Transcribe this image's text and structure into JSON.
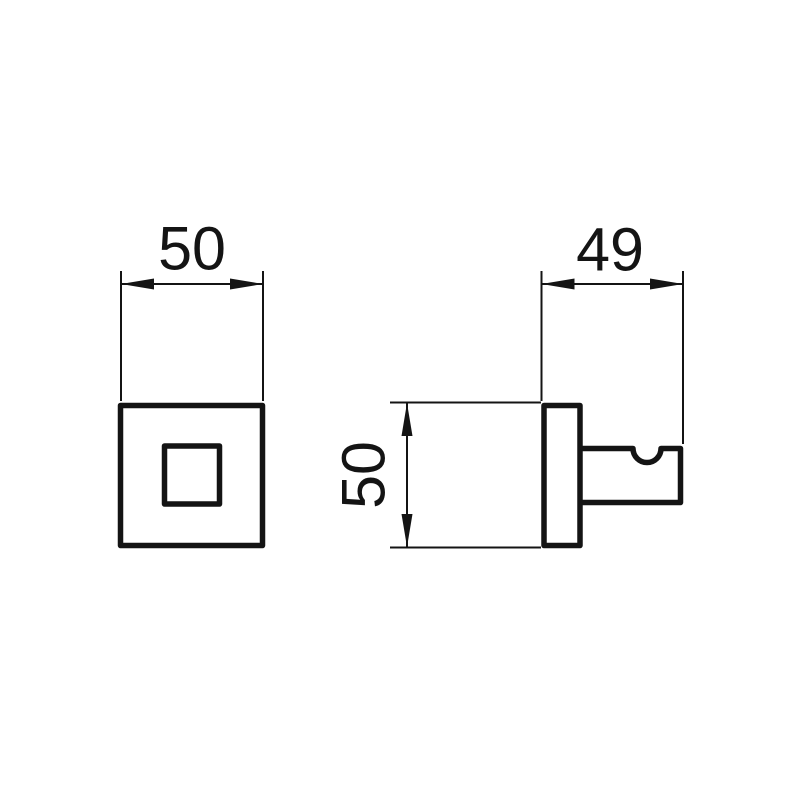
{
  "diagram": {
    "type": "technical-dimension-drawing",
    "background_color": "#ffffff",
    "line_color": "#141414",
    "views": {
      "front": {
        "dimensions": {
          "width": "50"
        }
      },
      "side": {
        "dimensions": {
          "depth": "49",
          "height": "50"
        }
      }
    }
  }
}
